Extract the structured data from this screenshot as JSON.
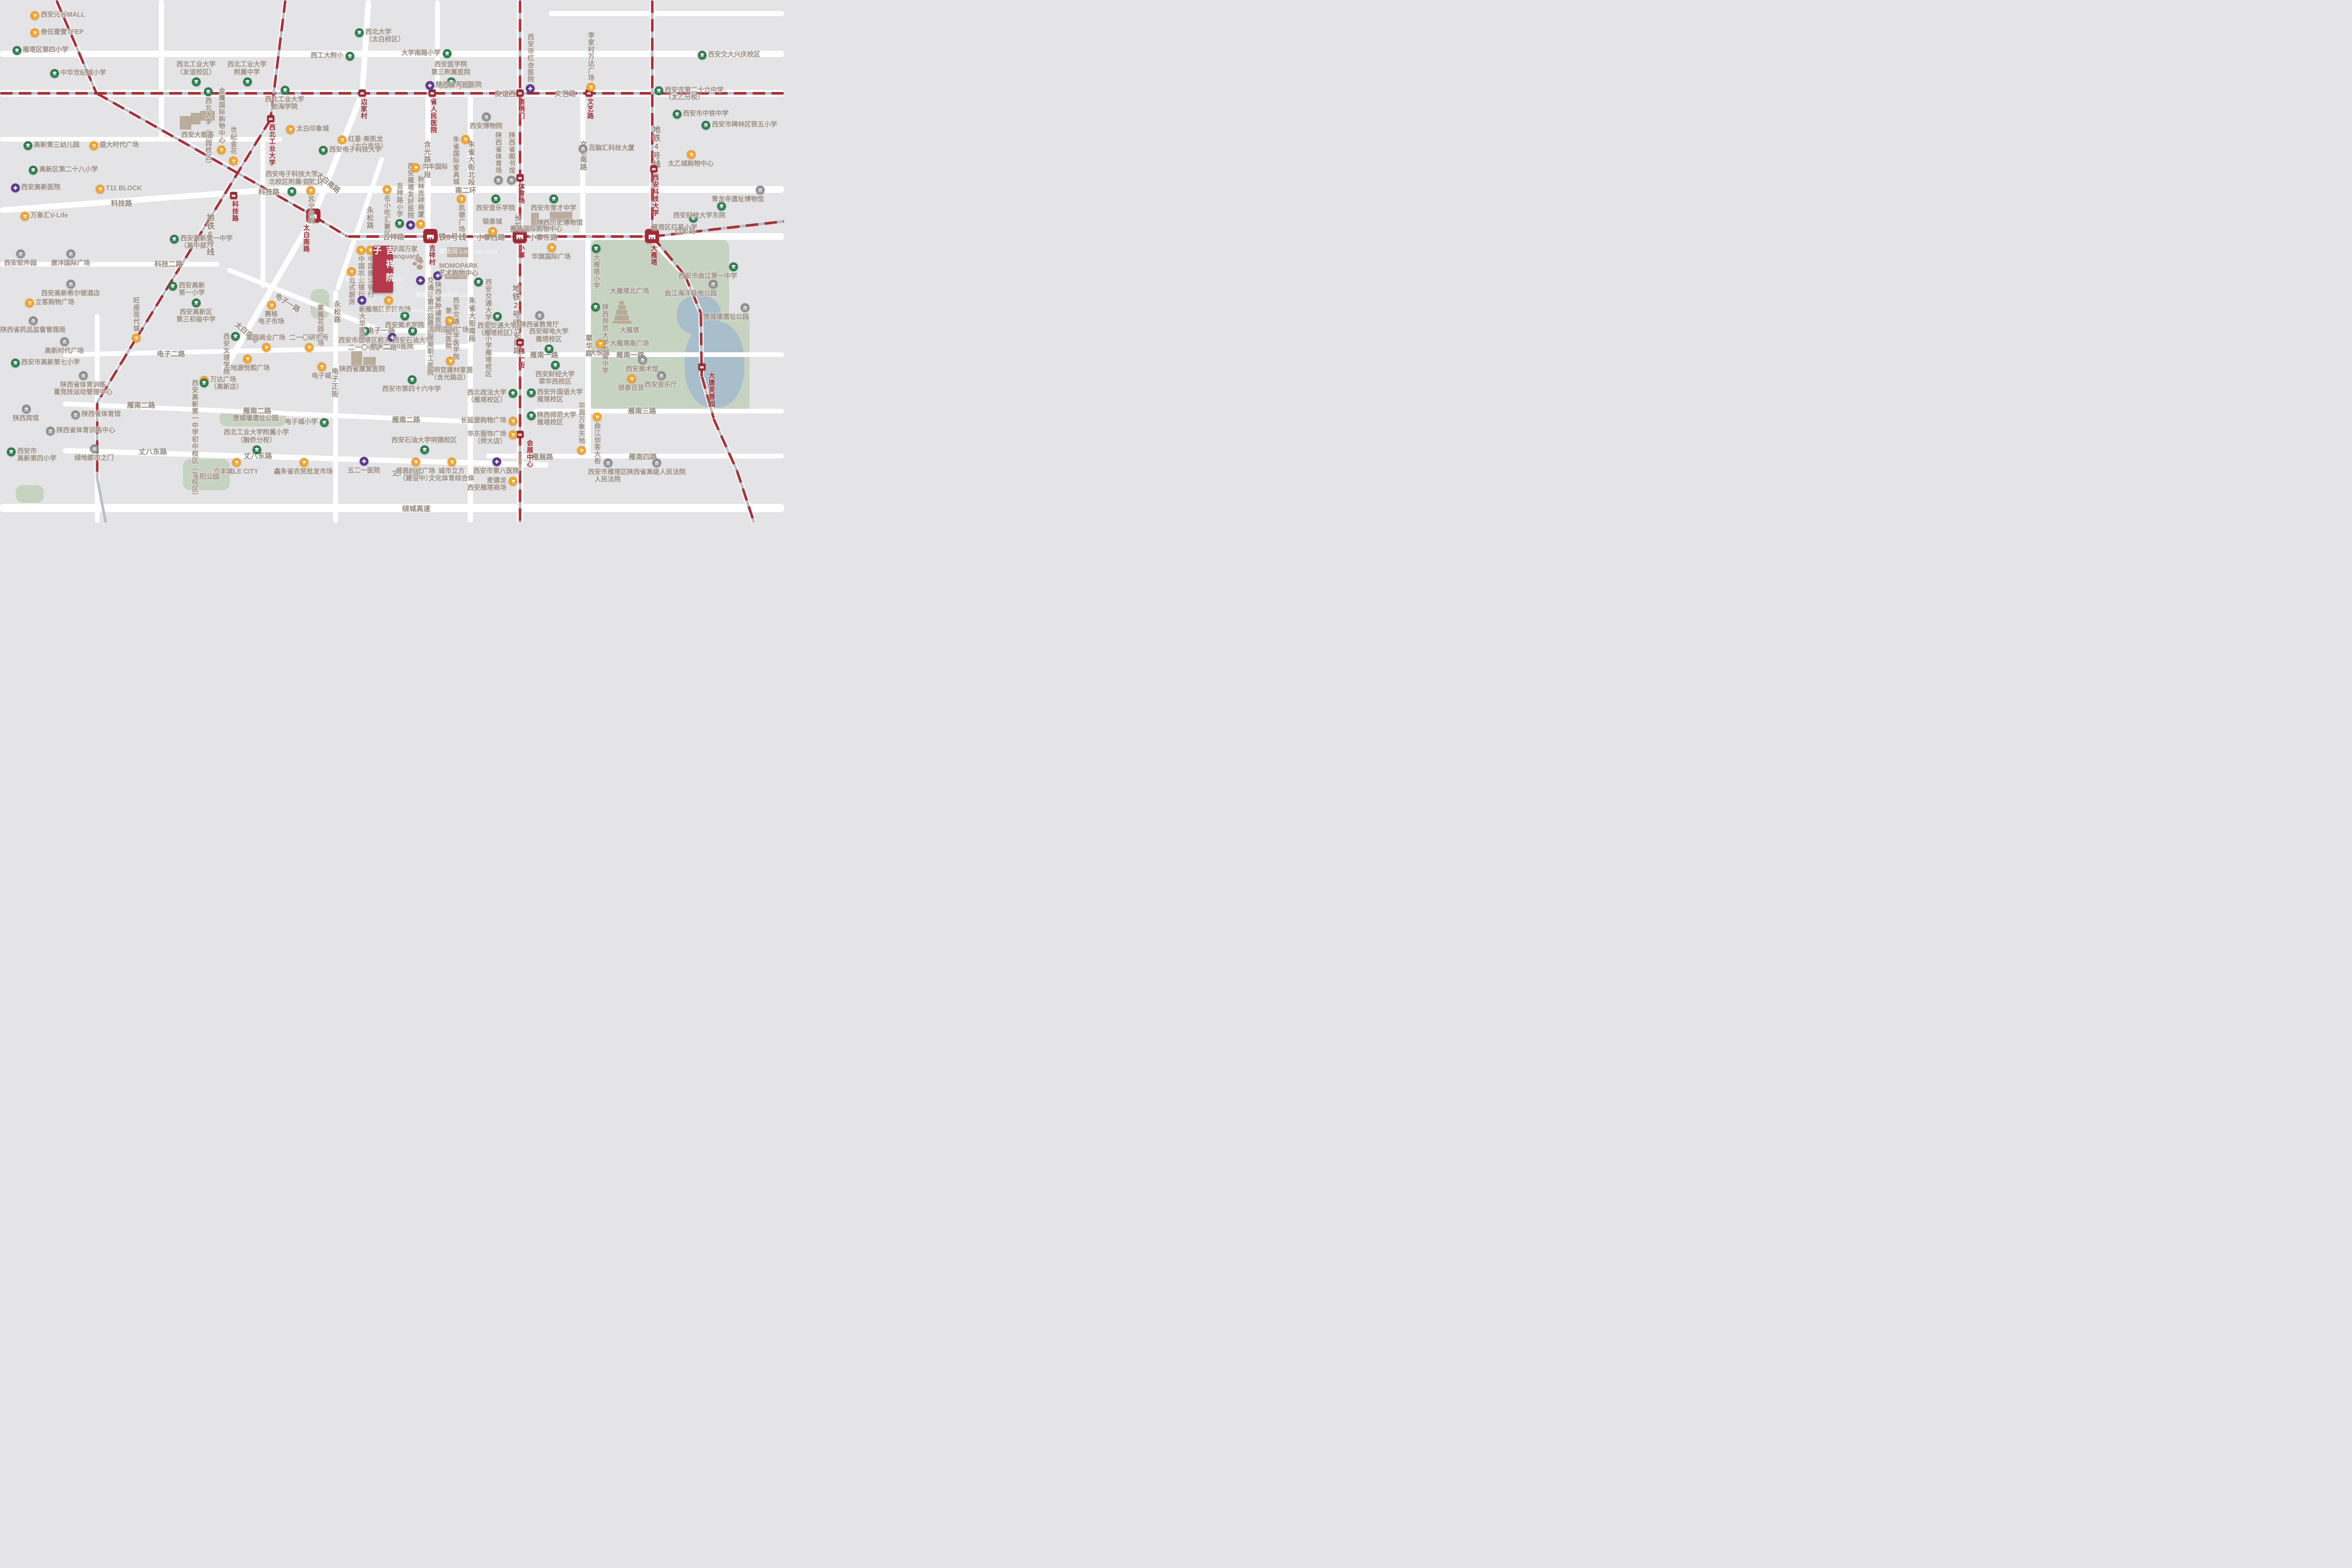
{
  "project": {
    "name": "吉祥院子",
    "x": 47.55,
    "y": 47.0
  },
  "watermark": "楼盘网 LouPan.com",
  "colors": {
    "metro_red": "#a8323a",
    "metro_silver": "#b9bdc5",
    "road": "#ffffff",
    "block": "#e4e4e6",
    "park": "#c7d3c1",
    "water": "#a9becb",
    "school": "#2f7d4f",
    "hospital": "#5b3a8e",
    "shop": "#f0a42f",
    "gov": "#8f9091",
    "station": "#9e2b33",
    "label": "#9d9084",
    "project": "#b23a4a"
  },
  "metro_line_labels": [
    {
      "x": 57.8,
      "y": 16.2,
      "l": "地铁1号线"
    },
    {
      "x": 57.2,
      "y": 45.3,
      "l": "地铁3号线"
    },
    {
      "x": 65.8,
      "y": 54.4,
      "l": "地铁2号线",
      "v": 1
    },
    {
      "x": 83.7,
      "y": 24.0,
      "l": "地铁4号线",
      "v": 1
    },
    {
      "x": 26.8,
      "y": 40.8,
      "l": "地铁6号线",
      "v": 1
    }
  ],
  "road_labels": [
    {
      "x": 64.9,
      "y": 17.8,
      "l": "友谊西路"
    },
    {
      "x": 72.1,
      "y": 17.8,
      "l": "文艺路"
    },
    {
      "x": 50.2,
      "y": 45.2,
      "l": "吉祥路"
    },
    {
      "x": 62.6,
      "y": 45.3,
      "l": "小寨西路"
    },
    {
      "x": 69.3,
      "y": 45.3,
      "l": "小寨东路"
    },
    {
      "x": 87.4,
      "y": 44.0,
      "l": "西影路"
    },
    {
      "x": 40.0,
      "y": 34.7,
      "l": "南二环"
    },
    {
      "x": 59.4,
      "y": 36.3,
      "l": "南二环"
    },
    {
      "x": 15.5,
      "y": 38.8,
      "l": "科技路"
    },
    {
      "x": 34.3,
      "y": 36.6,
      "l": "科技路"
    },
    {
      "x": 21.5,
      "y": 50.4,
      "l": "科技二路"
    },
    {
      "x": 36.7,
      "y": 57.8,
      "l": "电子一路",
      "rot": 33
    },
    {
      "x": 48.6,
      "y": 63.1,
      "l": "电子一路"
    },
    {
      "x": 21.8,
      "y": 67.6,
      "l": "电子二路"
    },
    {
      "x": 48.8,
      "y": 66.3,
      "l": "电子二路"
    },
    {
      "x": 18.0,
      "y": 77.4,
      "l": "雁南二路"
    },
    {
      "x": 32.8,
      "y": 78.5,
      "l": "雁南二路"
    },
    {
      "x": 51.8,
      "y": 80.2,
      "l": "雁南二路"
    },
    {
      "x": 19.5,
      "y": 86.3,
      "l": "丈八东路"
    },
    {
      "x": 32.9,
      "y": 87.1,
      "l": "丈八东路"
    },
    {
      "x": 51.8,
      "y": 90.4,
      "l": "丈八东路"
    },
    {
      "x": 53.1,
      "y": 97.2,
      "l": "绕城高速"
    },
    {
      "x": 69.4,
      "y": 67.8,
      "l": "雁南一路"
    },
    {
      "x": 80.4,
      "y": 67.8,
      "l": "雁南一路"
    },
    {
      "x": 81.9,
      "y": 78.5,
      "l": "雁南三路"
    },
    {
      "x": 69.2,
      "y": 87.3,
      "l": "雁展路"
    },
    {
      "x": 82.0,
      "y": 87.3,
      "l": "雁南四路"
    },
    {
      "x": 54.4,
      "y": 26.9,
      "l": "含光路中段",
      "v": 1
    },
    {
      "x": 54.8,
      "y": 57.0,
      "l": "含光路南段",
      "v": 1
    },
    {
      "x": 60.0,
      "y": 26.9,
      "l": "朱雀大街北段",
      "v": 1
    },
    {
      "x": 60.1,
      "y": 56.8,
      "l": "朱雀大街南段",
      "v": 1
    },
    {
      "x": 65.9,
      "y": 41.0,
      "l": "长安中路",
      "v": 1
    },
    {
      "x": 65.8,
      "y": 62.0,
      "l": "长安南路",
      "v": 1
    },
    {
      "x": 74.3,
      "y": 26.9,
      "l": "文艺南路",
      "v": 1
    },
    {
      "x": 75.0,
      "y": 64.0,
      "l": "翠华路",
      "v": 1
    },
    {
      "x": 42.6,
      "y": 70.3,
      "l": "电子正街",
      "v": 1
    },
    {
      "x": 47.1,
      "y": 39.5,
      "l": "永松路",
      "v": 1
    },
    {
      "x": 42.9,
      "y": 57.5,
      "l": "永松路",
      "v": 1
    },
    {
      "x": 41.9,
      "y": 34.8,
      "l": "太白南路",
      "rot": 40
    },
    {
      "x": 31.5,
      "y": 63.5,
      "l": "太白南路",
      "rot": 40
    }
  ],
  "stations": [
    {
      "x": 46.2,
      "y": 17.8,
      "n": "边家村",
      "lp": "bv"
    },
    {
      "x": 55.1,
      "y": 17.8,
      "n": "省人民医院",
      "lp": "bv"
    },
    {
      "x": 66.3,
      "y": 17.8,
      "n": "南稍门",
      "lp": "bv"
    },
    {
      "x": 75.1,
      "y": 17.8,
      "n": "文艺路",
      "lp": "bv"
    },
    {
      "x": 34.5,
      "y": 22.7,
      "n": "西北工业大学",
      "lp": "bv"
    },
    {
      "x": 29.8,
      "y": 37.4,
      "n": "科技路",
      "lp": "bv"
    },
    {
      "x": 83.4,
      "y": 32.3,
      "n": "西安科技大学",
      "lp": "bv"
    },
    {
      "x": 66.3,
      "y": 34.0,
      "n": "体育场",
      "lp": "bv"
    },
    {
      "x": 66.3,
      "y": 65.5,
      "n": "纬一街",
      "lp": "bv"
    },
    {
      "x": 66.3,
      "y": 83.1,
      "n": "会展中心",
      "lp": "rv"
    },
    {
      "x": 89.5,
      "y": 70.2,
      "n": "大唐芙蓉园",
      "lp": "rv"
    },
    {
      "x": 40.0,
      "y": 41.3,
      "n": "太白南路",
      "big": 1,
      "lp": "lv"
    },
    {
      "x": 54.9,
      "y": 45.2,
      "n": "吉祥村",
      "big": 1,
      "lp": "bv"
    },
    {
      "x": 66.3,
      "y": 45.2,
      "n": "小寨",
      "big": 1,
      "lp": "bv"
    },
    {
      "x": 83.2,
      "y": 45.2,
      "n": "大雁塔",
      "big": 1,
      "lp": "bv"
    }
  ],
  "pois": [
    {
      "t": "shop",
      "x": 4.4,
      "y": 2.9,
      "l": "西安元谷MALL"
    },
    {
      "t": "shop",
      "x": 4.4,
      "y": 6.2,
      "l": "叁伍壹壹TFEP"
    },
    {
      "t": "school",
      "x": 2.1,
      "y": 9.6,
      "l": "雁塔区第四小学"
    },
    {
      "t": "school",
      "x": 6.9,
      "y": 14.0,
      "l": "中华世纪城小学"
    },
    {
      "t": "school",
      "x": 3.5,
      "y": 27.8,
      "l": "高新第三幼儿园"
    },
    {
      "t": "school",
      "x": 4.2,
      "y": 32.5,
      "l": "高新区第二十八小学"
    },
    {
      "t": "hospital",
      "x": 1.9,
      "y": 35.9,
      "l": "西安高新医院"
    },
    {
      "t": "shop",
      "x": 3.1,
      "y": 41.3,
      "l": "万象汇V-Life"
    },
    {
      "t": "shop",
      "x": 11.9,
      "y": 27.8,
      "l": "盛大时代广场"
    },
    {
      "t": "shop",
      "x": 12.7,
      "y": 36.1,
      "l": "T11 BLOCK"
    },
    {
      "t": "gov",
      "x": 2.6,
      "y": 48.5,
      "l": "西安软件园",
      "lp": "b"
    },
    {
      "t": "gov",
      "x": 9.0,
      "y": 48.5,
      "l": "唐沣国际广场",
      "lp": "b"
    },
    {
      "t": "gov",
      "x": 9.0,
      "y": 54.3,
      "l": "西安高新希尔顿酒店",
      "lp": "b"
    },
    {
      "t": "shop",
      "x": 3.7,
      "y": 57.9,
      "l": "立客购物广场"
    },
    {
      "t": "gov",
      "x": 4.2,
      "y": 61.3,
      "l": "陕西省药品监督管理局",
      "lp": "b"
    },
    {
      "t": "gov",
      "x": 8.2,
      "y": 65.3,
      "l": "高新时代广场",
      "lp": "b"
    },
    {
      "t": "school",
      "x": 22.2,
      "y": 45.7,
      "l": "西安高新第一中学",
      "l2": "（高中部）"
    },
    {
      "t": "school",
      "x": 22.0,
      "y": 54.7,
      "l": "西安高新",
      "l2": "第一小学"
    },
    {
      "t": "shop",
      "x": 17.3,
      "y": 64.6,
      "l": "旺座现代城",
      "lp": "tv"
    },
    {
      "t": "school",
      "x": 1.9,
      "y": 69.4,
      "l": "西安市高新第七小学"
    },
    {
      "t": "gov",
      "x": 10.6,
      "y": 71.8,
      "l": "陕西省体育训练",
      "l2": "重竞技运动管理中心",
      "lp": "b"
    },
    {
      "t": "shop",
      "x": 26.0,
      "y": 72.7,
      "l": "万达广场",
      "l2": "（高新店）"
    },
    {
      "t": "gov",
      "x": 3.3,
      "y": 78.2,
      "l": "陕西宾馆",
      "lp": "b"
    },
    {
      "t": "gov",
      "x": 9.6,
      "y": 79.3,
      "l": "陕西省体育馆"
    },
    {
      "t": "gov",
      "x": 6.4,
      "y": 82.4,
      "l": "陕西省体育训练中心"
    },
    {
      "t": "school",
      "x": 1.4,
      "y": 86.4,
      "l": "西安市",
      "l2": "高新第四小学"
    },
    {
      "t": "gov",
      "x": 12.0,
      "y": 85.8,
      "l": "绿地都市之门",
      "lp": "b"
    },
    {
      "t": "shop",
      "x": 30.1,
      "y": 88.4,
      "l": "立丰城LE CITY",
      "lp": "b"
    },
    {
      "t": "shop",
      "x": 38.7,
      "y": 88.4,
      "l": "鑫朱雀农贸批发市场",
      "lp": "b"
    },
    {
      "t": "school",
      "x": 32.7,
      "y": 86.0,
      "l": "西北工业大学附属小学",
      "l2": "（融侨分校）",
      "lp": "t"
    },
    {
      "t": "school",
      "x": 41.3,
      "y": 80.8,
      "l": "电子城小学",
      "lp": "l"
    },
    {
      "t": "shop",
      "x": 31.5,
      "y": 68.6,
      "l": "天地源悦熙广场",
      "lp": "b"
    },
    {
      "t": "school",
      "x": 25.0,
      "y": 57.9,
      "l": "西安高新区",
      "l2": "第三初级中学",
      "lp": "b"
    },
    {
      "t": "school",
      "x": 30.0,
      "y": 64.3,
      "l": "西安文理学院",
      "lp": "lv"
    },
    {
      "t": "shop",
      "x": 34.6,
      "y": 58.3,
      "l": "赛格",
      "l2": "电子市场",
      "lp": "b"
    },
    {
      "t": "shop",
      "x": 33.9,
      "y": 66.4,
      "l": "栗园商业广场",
      "lp": "t"
    },
    {
      "t": "shop",
      "x": 39.4,
      "y": 66.4,
      "l": "二一〇研究所",
      "lp": "t"
    },
    {
      "t": "school",
      "x": 26.0,
      "y": 73.2,
      "l": "西安高新第一中学初中校区",
      "l2": "（东校区）",
      "lp": "lv"
    },
    {
      "t": "shop",
      "x": 41.0,
      "y": 70.1,
      "l": "电子城",
      "lp": "b"
    },
    {
      "t": "school",
      "x": 46.5,
      "y": 63.3,
      "l": "西安市雁塔区航天",
      "l2": "二一〇小学",
      "lp": "b"
    },
    {
      "t": "hospital",
      "x": 50.0,
      "y": 64.5,
      "l": "航天二一0医院",
      "lp": "b"
    },
    {
      "t": "school",
      "x": 52.6,
      "y": 63.3,
      "l": "西安石油大学",
      "lp": "b"
    },
    {
      "t": "plain",
      "x": 46.2,
      "y": 70.6,
      "l": "陕西省康复医院"
    },
    {
      "t": "school",
      "x": 52.5,
      "y": 72.6,
      "l": "西安市第四十六中学",
      "lp": "b"
    },
    {
      "t": "shop",
      "x": 57.4,
      "y": 69.0,
      "l": "大明宫建材家居",
      "l2": "（含光路店）",
      "lp": "b"
    },
    {
      "t": "school",
      "x": 25.0,
      "y": 15.6,
      "l": "西北工业大学",
      "l2": "（友谊校区）",
      "lp": "t"
    },
    {
      "t": "school",
      "x": 31.5,
      "y": 15.6,
      "l": "西北工业大学",
      "l2": "附属中学",
      "lp": "t"
    },
    {
      "t": "school",
      "x": 36.3,
      "y": 17.2,
      "l": "西北工业大学",
      "l2": "航海学院",
      "lp": "b"
    },
    {
      "t": "school",
      "x": 45.8,
      "y": 6.2,
      "l": "西北大学",
      "l2": "（太白校区）"
    },
    {
      "t": "school",
      "x": 44.6,
      "y": 10.7,
      "l": "西工大附小",
      "lp": "l"
    },
    {
      "t": "school",
      "x": 57.0,
      "y": 10.2,
      "l": "大学南路小学",
      "lp": "l"
    },
    {
      "t": "school",
      "x": 57.5,
      "y": 15.6,
      "l": "西安医学院",
      "l2": "第三附属医院",
      "lp": "t"
    },
    {
      "t": "hospital",
      "x": 54.8,
      "y": 16.3,
      "l": "陕西省人民医院"
    },
    {
      "t": "hospital",
      "x": 67.6,
      "y": 16.9,
      "l": "西安市红会医院",
      "lp": "tv"
    },
    {
      "t": "shop",
      "x": 75.3,
      "y": 16.6,
      "l": "李家村万达广场",
      "lp": "tv"
    },
    {
      "t": "school",
      "x": 26.5,
      "y": 17.5,
      "l": "西北大学（桃园校区）",
      "lp": "bv"
    },
    {
      "t": "plain",
      "x": 25.2,
      "y": 25.8,
      "l": "西安大都荟"
    },
    {
      "t": "shop",
      "x": 28.2,
      "y": 28.6,
      "l": "金鹰国际购物中心",
      "lp": "tv"
    },
    {
      "t": "shop",
      "x": 29.7,
      "y": 30.7,
      "l": "世纪金花",
      "lp": "tv"
    },
    {
      "t": "shop",
      "x": 37.0,
      "y": 24.7,
      "l": "太白印象城"
    },
    {
      "t": "shop",
      "x": 43.6,
      "y": 26.7,
      "l": "红星·美凯龙",
      "l2": "（太白商场）"
    },
    {
      "t": "school",
      "x": 41.2,
      "y": 28.7,
      "l": "西安电子科技大学"
    },
    {
      "t": "school",
      "x": 37.2,
      "y": 36.6,
      "l": "西安电子科技大学",
      "l2": "北校区附属小学",
      "lp": "t"
    },
    {
      "t": "shop",
      "x": 39.6,
      "y": 36.4,
      "l": "苏宁易购",
      "lp": "bv"
    },
    {
      "t": "food",
      "x": 49.3,
      "y": 36.2,
      "l": "名小吃汇聚区",
      "lp": "bv"
    },
    {
      "t": "school",
      "x": 50.9,
      "y": 42.7,
      "l": "吉祥路小学",
      "lp": "tv"
    },
    {
      "t": "hospital",
      "x": 52.3,
      "y": 43.0,
      "l": "西安雁塔友好医院",
      "lp": "tv"
    },
    {
      "t": "shop",
      "x": 53.6,
      "y": 42.8,
      "l": "秋林吉祥商厦",
      "lp": "tv"
    },
    {
      "t": "shop",
      "x": 53.0,
      "y": 32.0,
      "l": "广丰国际"
    },
    {
      "t": "shop",
      "x": 46.0,
      "y": 47.8,
      "l": "中国农业银行",
      "lp": "bv"
    },
    {
      "t": "shop",
      "x": 47.2,
      "y": 47.8,
      "l": "中国建设银行",
      "lp": "bv"
    },
    {
      "t": "shop",
      "x": 44.8,
      "y": 51.9,
      "l": "俄式厨房",
      "lp": "bv"
    },
    {
      "t": "hospital",
      "x": 46.1,
      "y": 57.4,
      "l": "新大华医院",
      "lp": "bv"
    },
    {
      "t": "shop",
      "x": 49.5,
      "y": 57.4,
      "l": "雁塔区便民市场",
      "lp": "b"
    },
    {
      "t": "school",
      "x": 51.6,
      "y": 60.4,
      "l": "西安美术学院",
      "lp": "b"
    },
    {
      "t": "hospital",
      "x": 53.6,
      "y": 53.6,
      "l": "交通部第二公路",
      "l2": "工程局职工医院",
      "lp": "rv"
    },
    {
      "t": "hospital",
      "x": 55.8,
      "y": 52.7,
      "l": "陕西省肿瘤医院",
      "lp": "bv"
    },
    {
      "t": "plain",
      "x": 58.5,
      "y": 51.6,
      "l": "MOMOPARK",
      "l2": "艺术购物中心"
    },
    {
      "t": "plain",
      "x": 57.6,
      "y": 56.8,
      "l": "西安交通大学医学院",
      "l2": "第一附属医院",
      "vv": 1
    },
    {
      "t": "shop",
      "x": 57.3,
      "y": 61.3,
      "l": "阳阳国际广场",
      "lp": "b"
    },
    {
      "t": "school",
      "x": 61.0,
      "y": 53.9,
      "l": "西安交通大学附属",
      "l2": "小学雁塔校区",
      "lp": "rv"
    },
    {
      "t": "school",
      "x": 63.4,
      "y": 60.5,
      "l": "西安交通大学",
      "l2": "（雁塔校区）",
      "lp": "b"
    },
    {
      "t": "school",
      "x": 70.6,
      "y": 38.0,
      "l": "西安市育才中学",
      "lp": "b"
    },
    {
      "t": "plain",
      "x": 71.4,
      "y": 42.6,
      "l": "陕西历史博物馆"
    },
    {
      "t": "plain",
      "x": 68.4,
      "y": 43.8,
      "l": "赛格国际购物中心"
    },
    {
      "t": "gov",
      "x": 62.0,
      "y": 22.3,
      "l": "西安博物院",
      "lp": "b"
    },
    {
      "t": "shop",
      "x": 59.3,
      "y": 26.6,
      "l": "朱雀国际家具城",
      "lp": "lv"
    },
    {
      "t": "gov",
      "x": 63.5,
      "y": 34.4,
      "l": "陕西省体育场",
      "lp": "tv"
    },
    {
      "t": "gov",
      "x": 65.2,
      "y": 34.4,
      "l": "陕西省图书馆",
      "lp": "tv"
    },
    {
      "t": "shop",
      "x": 58.8,
      "y": 38.0,
      "l": "凯德广场",
      "lp": "bv"
    },
    {
      "t": "school",
      "x": 63.2,
      "y": 38.0,
      "l": "西安音乐学院",
      "lp": "b"
    },
    {
      "t": "shop",
      "x": 62.8,
      "y": 44.2,
      "l": "银泰城",
      "lp": "t"
    },
    {
      "t": "shop",
      "x": 70.3,
      "y": 47.3,
      "l": "华旗国际广场",
      "lp": "b"
    },
    {
      "t": "school",
      "x": 76.0,
      "y": 47.5,
      "l": "大雁塔小学",
      "lp": "bv"
    },
    {
      "t": "school",
      "x": 75.9,
      "y": 58.7,
      "l": "陕西师范大学附属中学",
      "lp": "rv"
    },
    {
      "t": "plain",
      "x": 80.3,
      "y": 55.7,
      "l": "大雁塔北广场"
    },
    {
      "t": "plain",
      "x": 80.3,
      "y": 63.2,
      "l": "大雁塔"
    },
    {
      "t": "plain",
      "x": 80.3,
      "y": 65.7,
      "l": "大雁塔南广场"
    },
    {
      "t": "shop",
      "x": 76.5,
      "y": 65.7,
      "l": "大悦城",
      "lp": "b"
    },
    {
      "t": "gov",
      "x": 68.8,
      "y": 60.3,
      "l": "陕西省教育厅",
      "lp": "b"
    },
    {
      "t": "school",
      "x": 70.0,
      "y": 66.7,
      "l": "西安邮电大学",
      "l2": "雁塔校区",
      "lp": "t"
    },
    {
      "t": "school",
      "x": 70.8,
      "y": 69.8,
      "l": "西安财经大学",
      "l2": "翠华西校区",
      "lp": "b"
    },
    {
      "t": "school",
      "x": 67.7,
      "y": 75.1,
      "l": "西安外国语大学",
      "l2": "雁塔校区"
    },
    {
      "t": "school",
      "x": 67.7,
      "y": 79.5,
      "l": "陕西师范大学",
      "l2": "雁塔校区"
    },
    {
      "t": "school",
      "x": 65.4,
      "y": 75.2,
      "l": "西北政法大学",
      "l2": "（雁塔校区）",
      "lp": "l"
    },
    {
      "t": "shop",
      "x": 65.4,
      "y": 80.5,
      "l": "长延堡购物广场",
      "lp": "l"
    },
    {
      "t": "shop",
      "x": 65.4,
      "y": 83.1,
      "l": "华东服饰广场",
      "l2": "（师大店）",
      "lp": "l"
    },
    {
      "t": "school",
      "x": 54.1,
      "y": 86.0,
      "l": "西安石油大学明德校区",
      "lp": "t"
    },
    {
      "t": "hospital",
      "x": 46.4,
      "y": 88.2,
      "l": "五二一医院",
      "lp": "b"
    },
    {
      "t": "shop",
      "x": 53.0,
      "y": 88.3,
      "l": "感恩时代广场",
      "l2": "（建设中）",
      "lp": "b"
    },
    {
      "t": "shop",
      "x": 57.6,
      "y": 88.3,
      "l": "城市立方",
      "l2": "文化体育综合体",
      "lp": "b"
    },
    {
      "t": "hospital",
      "x": 63.3,
      "y": 88.3,
      "l": "西安市第八医院",
      "lp": "b"
    },
    {
      "t": "shop",
      "x": 65.4,
      "y": 92.0,
      "l": "麦德龙",
      "l2": "西安雁塔商场",
      "lp": "l"
    },
    {
      "t": "gov",
      "x": 77.5,
      "y": 88.5,
      "l": "西安市雁塔区",
      "l2": "人民法院",
      "lp": "b"
    },
    {
      "t": "gov",
      "x": 83.7,
      "y": 88.5,
      "l": "陕西省高级人民法院",
      "lp": "b"
    },
    {
      "t": "shop",
      "x": 74.1,
      "y": 86.1,
      "l": "华润万象天地",
      "lp": "tv"
    },
    {
      "t": "shop",
      "x": 76.1,
      "y": 79.7,
      "l": "曲江创客大街",
      "lp": "bv"
    },
    {
      "t": "shop",
      "x": 80.5,
      "y": 72.4,
      "l": "银泰百货",
      "lp": "b"
    },
    {
      "t": "gov",
      "x": 81.9,
      "y": 68.8,
      "l": "西安美术馆",
      "lp": "b"
    },
    {
      "t": "gov",
      "x": 84.3,
      "y": 71.8,
      "l": "西安音乐厅",
      "lp": "b"
    },
    {
      "t": "plain",
      "x": 32.6,
      "y": 80.0,
      "l": "唐城墙遗址公园"
    },
    {
      "t": "plain",
      "x": 26.3,
      "y": 91.2,
      "l": "永阳公园"
    },
    {
      "t": "plain",
      "x": 40.8,
      "y": 58.2,
      "l": "紫薇花园广场",
      "vv": 0,
      "lp": "v"
    },
    {
      "t": "gov",
      "x": 90.9,
      "y": 54.3,
      "l": "曲江海洋极地公园",
      "lp": "bl"
    },
    {
      "t": "gov",
      "x": 95.0,
      "y": 58.8,
      "l": "唐城墙遗址公园",
      "lp": "bl"
    },
    {
      "t": "school",
      "x": 93.5,
      "y": 51.0,
      "l": "西安市曲江第一中学",
      "lp": "bl"
    },
    {
      "t": "school",
      "x": 88.4,
      "y": 41.7,
      "l": "雁塔区红星小学",
      "lp": "bl"
    },
    {
      "t": "school",
      "x": 92.0,
      "y": 39.4,
      "l": "西安科技大学东院",
      "lp": "bl"
    },
    {
      "t": "gov",
      "x": 96.9,
      "y": 36.3,
      "l": "青龙寺遗址博物馆",
      "lp": "bl"
    },
    {
      "t": "shop",
      "x": 88.1,
      "y": 29.5,
      "l": "太乙城购物中心",
      "lp": "b"
    },
    {
      "t": "school",
      "x": 86.3,
      "y": 21.8,
      "l": "西安市中铁中学"
    },
    {
      "t": "school",
      "x": 90.0,
      "y": 23.9,
      "l": "西安市碑林区铁五小学"
    },
    {
      "t": "school",
      "x": 89.5,
      "y": 10.5,
      "l": "西安交大兴庆校区"
    },
    {
      "t": "school",
      "x": 84.0,
      "y": 17.3,
      "l": "西安市第二十六中学",
      "l2": "（太乙分校）"
    },
    {
      "t": "gov",
      "x": 74.3,
      "y": 28.4,
      "l": "百脑汇科技大厦"
    },
    {
      "t": "plain",
      "x": 51.6,
      "y": 48.4,
      "l": "华润万家",
      "l2": "vanguard"
    }
  ]
}
